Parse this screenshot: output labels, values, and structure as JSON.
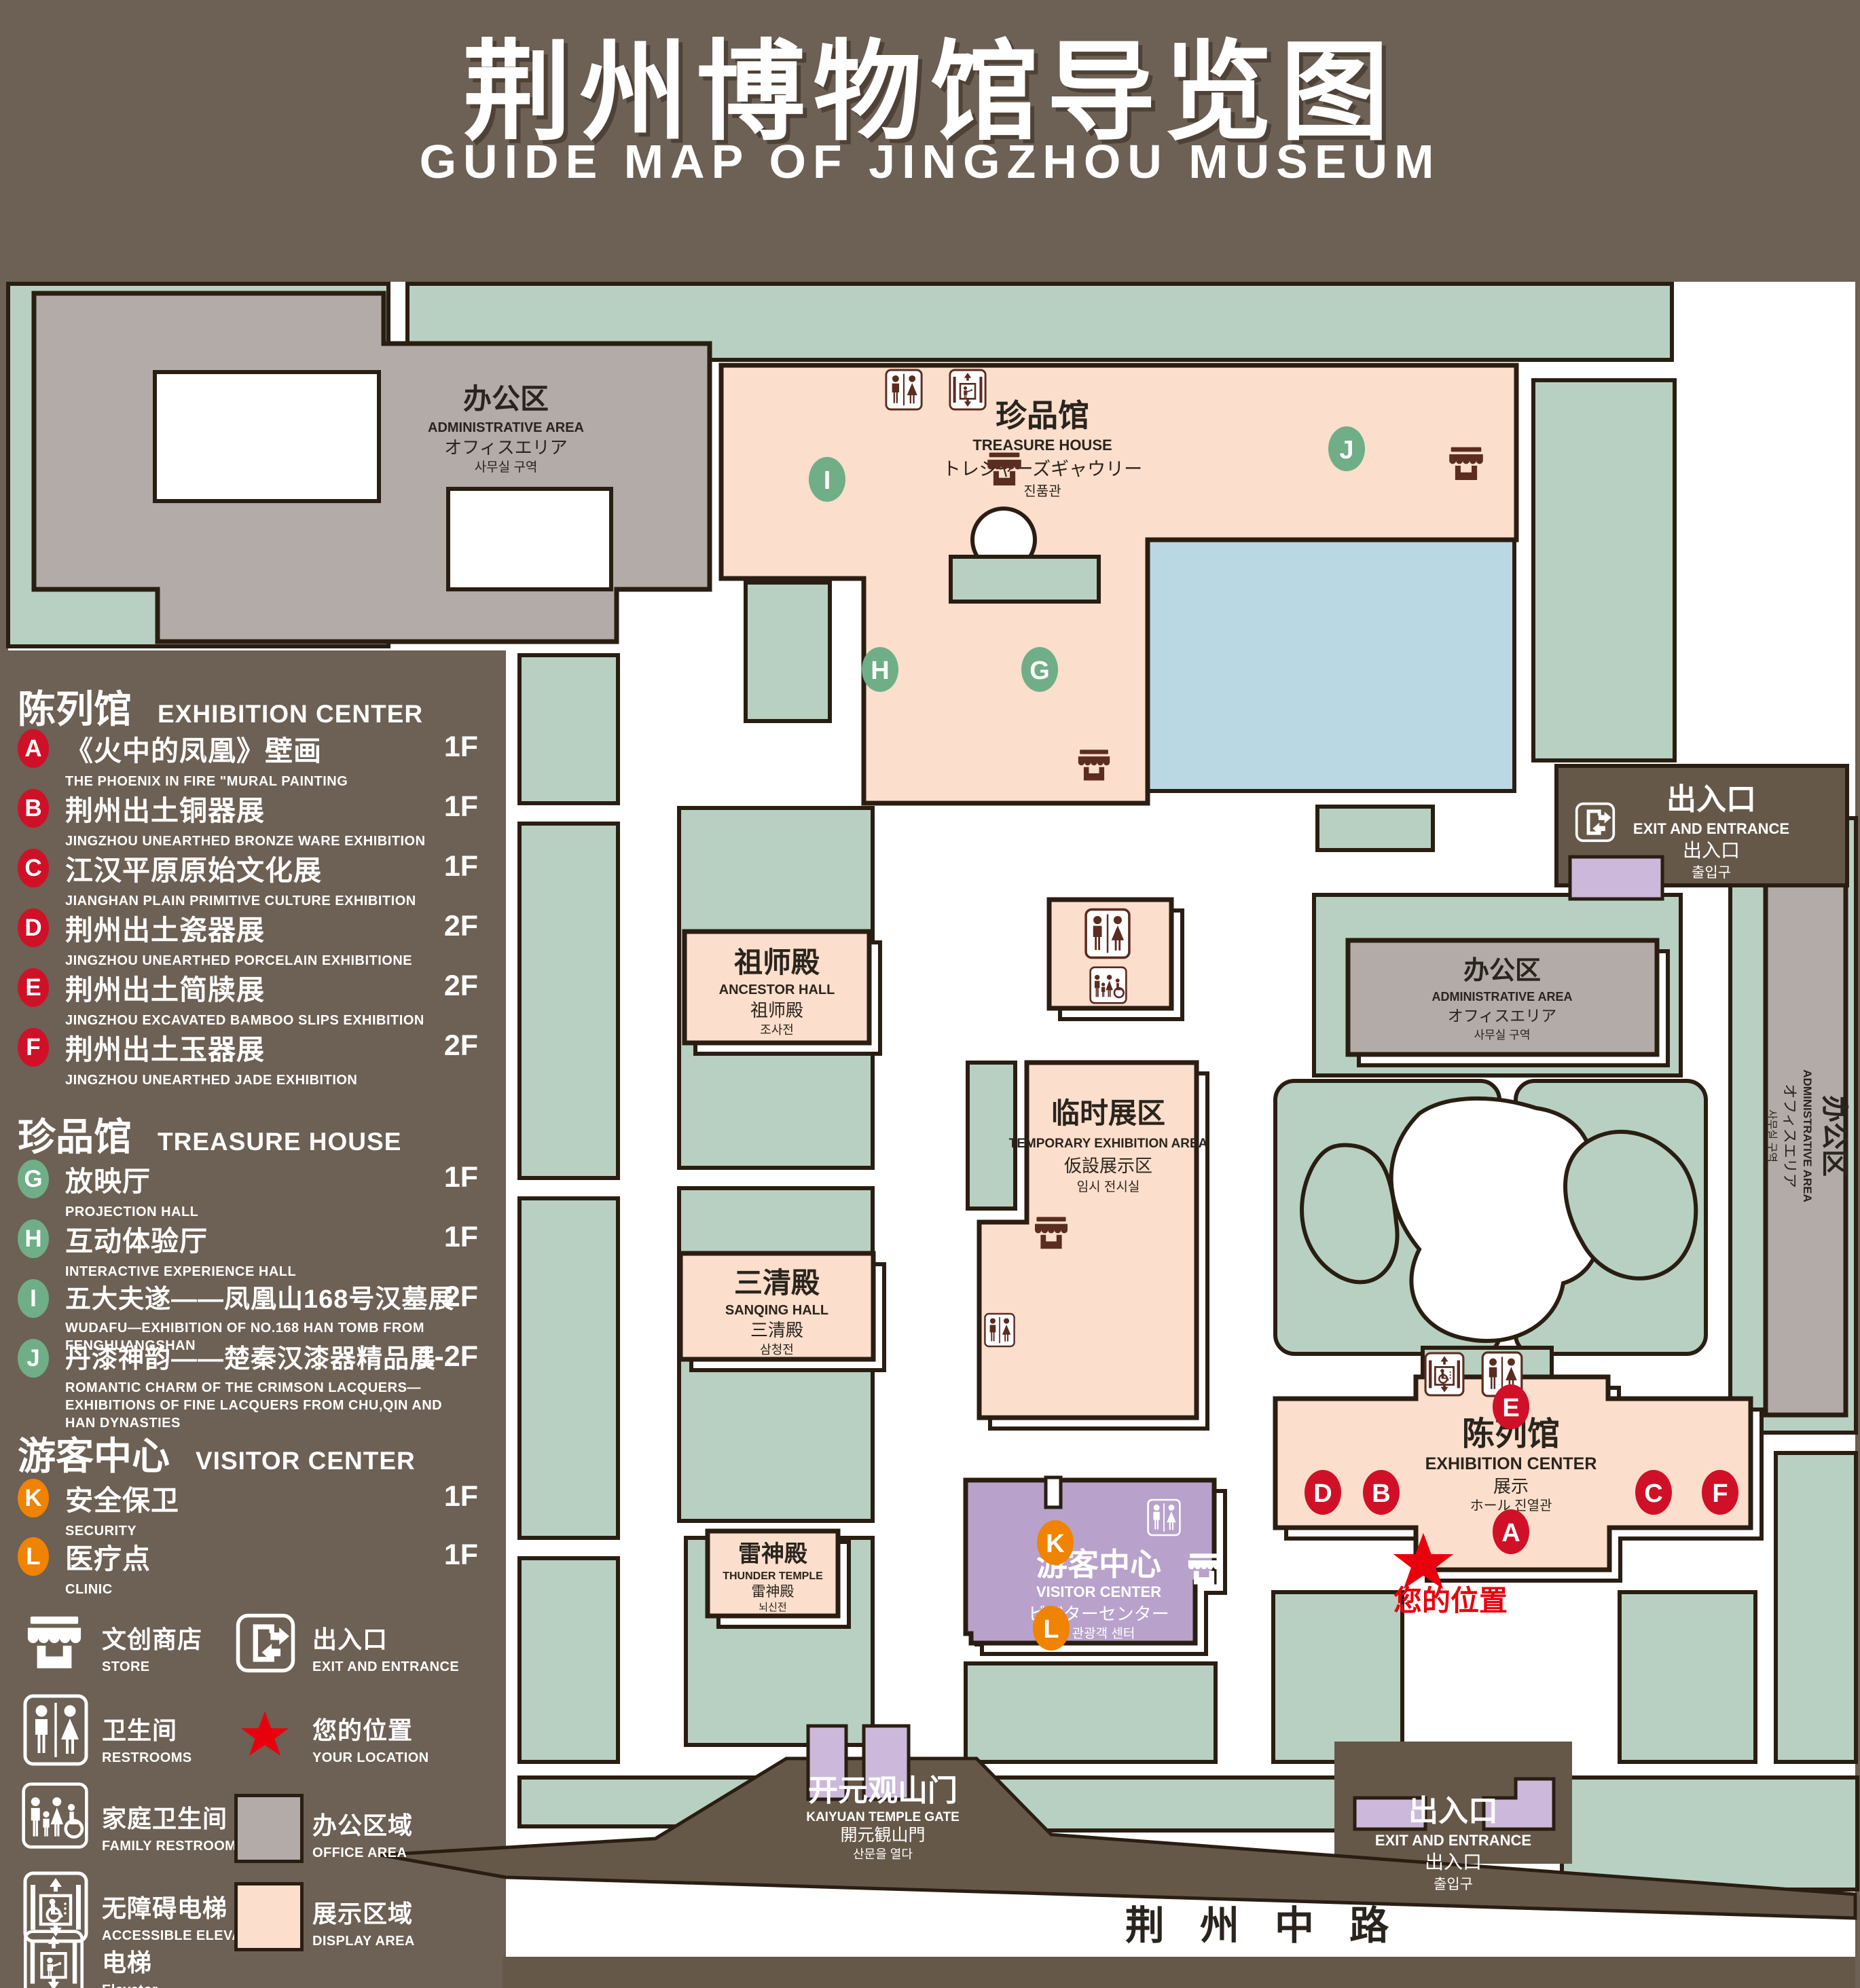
{
  "title": {
    "zh": "荆州博物馆导览图",
    "en": "GUIDE MAP OF JINGZHOU MUSEUM"
  },
  "colors": {
    "background": "#6d6054",
    "outline": "#2a1d12",
    "lawn": "#b7d0c1",
    "display_area": "#fbdecb",
    "office_area": "#b2aba7",
    "water": "#b9d8e3",
    "visitor_purple": "#b8a2cb",
    "gate_purple": "#cbb8da",
    "badge_red": "#d01027",
    "badge_green": "#6fae87",
    "badge_orange": "#f08300",
    "star_red": "#e8000d"
  },
  "legend": {
    "sections": [
      {
        "zh": "陈列馆",
        "en": "EXHIBITION CENTER",
        "items": [
          {
            "key": "A",
            "zh": "《火中的凤凰》壁画",
            "en": "THE PHOENIX IN FIRE \"MURAL PAINTING",
            "floor": "1F"
          },
          {
            "key": "B",
            "zh": "荆州出土铜器展",
            "en": "JINGZHOU UNEARTHED BRONZE WARE EXHIBITION",
            "floor": "1F"
          },
          {
            "key": "C",
            "zh": "江汉平原原始文化展",
            "en": "JIANGHAN PLAIN PRIMITIVE CULTURE EXHIBITION",
            "floor": "1F"
          },
          {
            "key": "D",
            "zh": "荆州出土瓷器展",
            "en": "JINGZHOU UNEARTHED PORCELAIN EXHIBITIONE",
            "floor": "2F"
          },
          {
            "key": "E",
            "zh": "荆州出土简牍展",
            "en": "JINGZHOU EXCAVATED BAMBOO SLIPS EXHIBITION",
            "floor": "2F"
          },
          {
            "key": "F",
            "zh": "荆州出土玉器展",
            "en": "JINGZHOU UNEARTHED JADE EXHIBITION",
            "floor": "2F"
          }
        ]
      },
      {
        "zh": "珍品馆",
        "en": "TREASURE HOUSE",
        "items": [
          {
            "key": "G",
            "zh": "放映厅",
            "en": "PROJECTION HALL",
            "floor": "1F"
          },
          {
            "key": "H",
            "zh": "互动体验厅",
            "en": "INTERACTIVE EXPERIENCE HALL",
            "floor": "1F"
          },
          {
            "key": "I",
            "zh": "五大夫遂——凤凰山168号汉墓展",
            "en": "WUDAFU—EXHIBITION OF NO.168 HAN TOMB FROM FENGHUANGSHAN",
            "floor": "2F"
          },
          {
            "key": "J",
            "zh": "丹漆神韵——楚秦汉漆器精品展",
            "en": "ROMANTIC CHARM OF THE CRIMSON LACQUERS—EXHIBITIONS OF FINE LACQUERS FROM CHU,QIN AND HAN DYNASTIES",
            "floor": "1-2F"
          }
        ]
      },
      {
        "zh": "游客中心",
        "en": "VISITOR CENTER",
        "items": [
          {
            "key": "K",
            "zh": "安全保卫",
            "en": "SECURITY",
            "floor": "1F"
          },
          {
            "key": "L",
            "zh": "医疗点",
            "en": "CLINIC",
            "floor": "1F"
          }
        ]
      }
    ],
    "symbols": [
      {
        "zh": "文创商店",
        "en": "STORE"
      },
      {
        "zh": "出入口",
        "en": "EXIT AND ENTRANCE"
      },
      {
        "zh": "卫生间",
        "en": "RESTROOMS"
      },
      {
        "zh": "您的位置",
        "en": "YOUR LOCATION"
      },
      {
        "zh": "家庭卫生间",
        "en": "FAMILY RESTROOMS"
      },
      {
        "zh": "办公区域",
        "en": "OFFICE AREA"
      },
      {
        "zh": "无障碍电梯",
        "en": "ACCESSIBLE ELEVATOR"
      },
      {
        "zh": "展示区域",
        "en": "DISPLAY AREA"
      },
      {
        "zh": "电梯",
        "en": "Elevator"
      }
    ]
  },
  "map": {
    "buildings": {
      "admin": {
        "zh": "办公区",
        "en": "ADMINISTRATIVE AREA",
        "ja": "オフィスエリア",
        "ko": "사무실 구역"
      },
      "treasure": {
        "zh": "珍品馆",
        "en": "TREASURE HOUSE",
        "ja": "トレジャーズギャウリー",
        "ko": "진품관"
      },
      "ancestor": {
        "zh": "祖师殿",
        "en": "ANCESTOR HALL",
        "ja": "祖师殿",
        "ko": "조사전"
      },
      "temporary": {
        "zh": "临时展区",
        "en": "TEMPORARY EXHIBITION AREA",
        "ja": "仮設展示区",
        "ko": "임시 전시실"
      },
      "sanqing": {
        "zh": "三清殿",
        "en": "SANQING HALL",
        "ja": "三清殿",
        "ko": "삼청전"
      },
      "thunder": {
        "zh": "雷神殿",
        "en": "THUNDER TEMPLE",
        "ja": "雷神殿",
        "ko": "뇌신전"
      },
      "visitor": {
        "zh": "游客中心",
        "en": "VISITOR CENTER",
        "ja": "ビジターセンター",
        "ko": "관광객 센터"
      },
      "exhibition": {
        "zh": "陈列馆",
        "en": "EXHIBITION CENTER",
        "zh2": "展示",
        "line4": "ホール 진열관"
      },
      "gate": {
        "zh": "开元观山门",
        "en": "KAIYUAN TEMPLE GATE",
        "ja": "開元観山門",
        "ko": "산문을 열다"
      },
      "exit": {
        "zh": "出入口",
        "en": "EXIT AND ENTRANCE",
        "ja": "出入口",
        "ko": "출입구"
      }
    },
    "road": "荆 州 中 路",
    "your_location": "您的位置"
  }
}
